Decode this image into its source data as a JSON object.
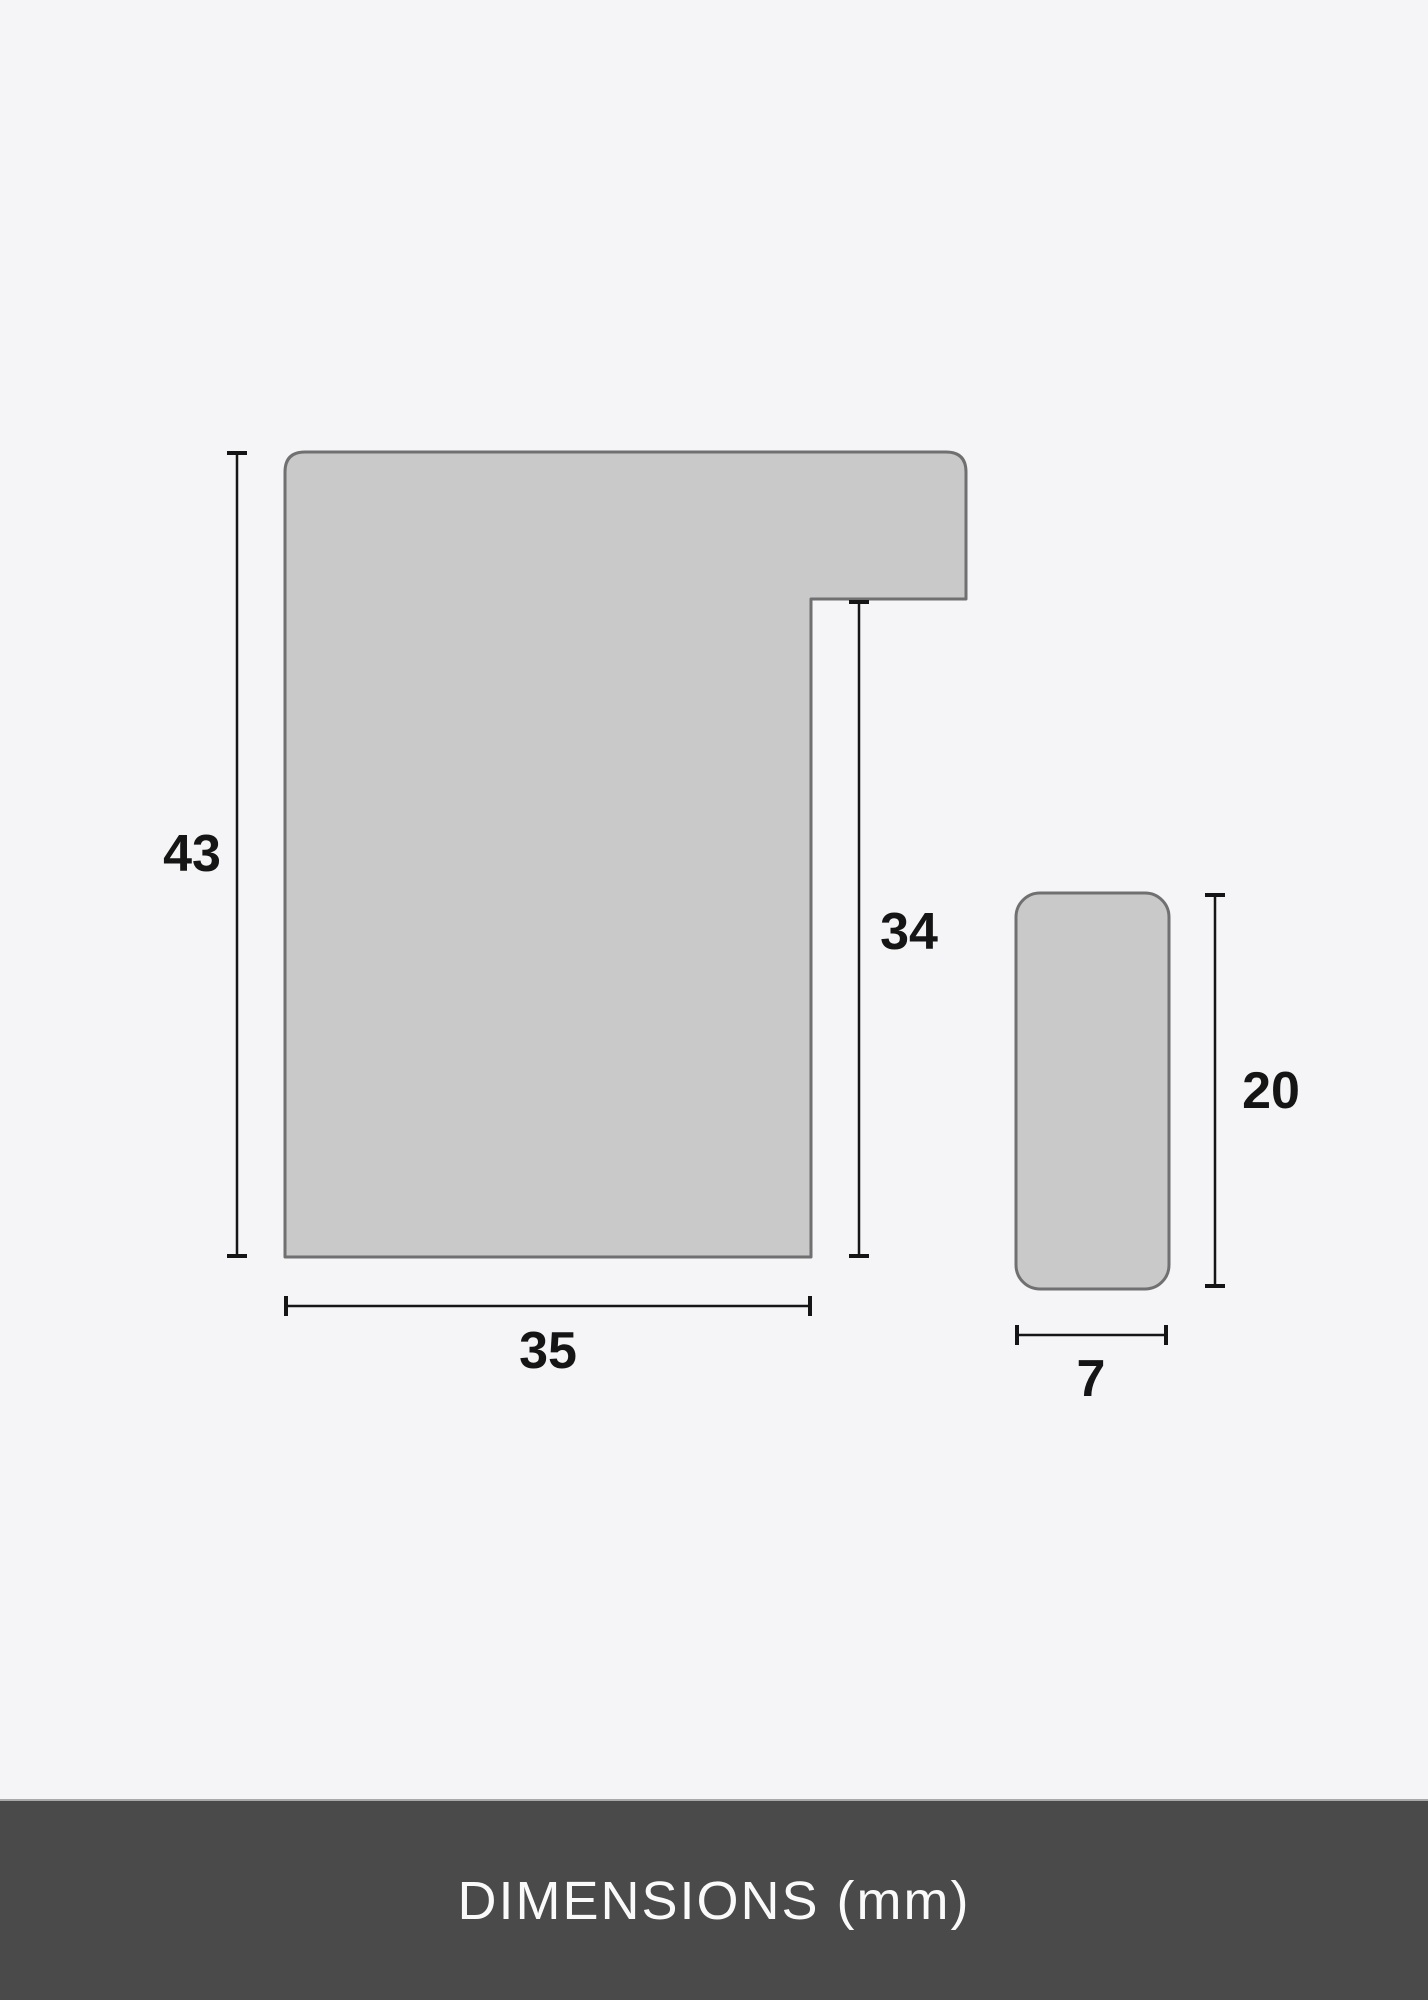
{
  "diagram": {
    "left_profile": {
      "height_label": "43",
      "inner_height_label": "34",
      "width_label": "35"
    },
    "right_profile": {
      "height_label": "20",
      "width_label": "7"
    }
  },
  "footer": {
    "title": "DIMENSIONS (mm)"
  },
  "colors": {
    "background": "#f5f5f7",
    "shape-fill": "#c9c9c9",
    "shape-stroke": "#707070",
    "dimension-ink": "#151515",
    "footer-bg": "#4a4a4a",
    "footer-text": "#fafafa",
    "footer-border": "#a9a9a9"
  }
}
